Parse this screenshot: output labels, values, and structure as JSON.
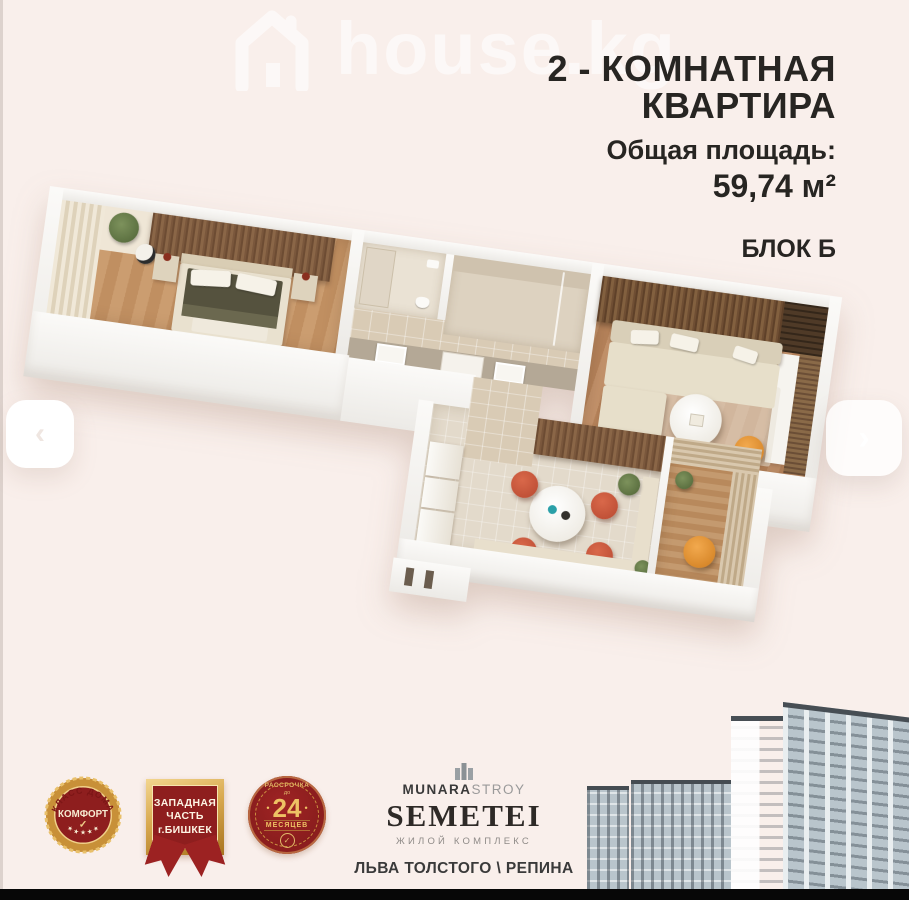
{
  "colors": {
    "background": "#f9efeb",
    "text": "#272522",
    "badge_red": "#8e1e1e",
    "badge_gold": "#d9a952",
    "accent_orange": "#e08b2b",
    "wood_floor": "#c6976b",
    "slat_brown": "#7a573c",
    "marble": "#d8cbb6",
    "sofa_beige": "#e7dfca",
    "building_facade": "#b9c5cc"
  },
  "watermark": {
    "text": "house.kg",
    "icon": "house-icon"
  },
  "header": {
    "title_line1": "2 - КОМНАТНАЯ",
    "title_line2": "КВАРТИРА",
    "area_label": "Общая площадь:",
    "area_value": "59,74 м²",
    "block_label": "БЛОК Б"
  },
  "carousel": {
    "prev_glyph": "‹",
    "next_glyph": "›"
  },
  "badges": {
    "comfort": {
      "arc_text": "КЛАСС ДОМА",
      "main_text": "КОМФОРТ",
      "check": "✓",
      "stars": "★ ★ ★ ★ ★"
    },
    "location": {
      "line1": "ЗАПАДНАЯ",
      "line2": "ЧАСТЬ",
      "line3": "г.БИШКЕК"
    },
    "installment": {
      "top_text": "РАССРОЧКА",
      "small_text": "до",
      "dot": "•",
      "number": "24",
      "bottom_text": "МЕСЯЦЕВ",
      "check": "✓"
    }
  },
  "developer": {
    "brand_bold": "MUNARA",
    "brand_light": "STROY",
    "complex_name": "SEMETEI",
    "complex_type": "ЖИЛОЙ КОМПЛЕКС",
    "address": "ЛЬВА ТОЛСТОГО \\ РЕПИНА"
  }
}
